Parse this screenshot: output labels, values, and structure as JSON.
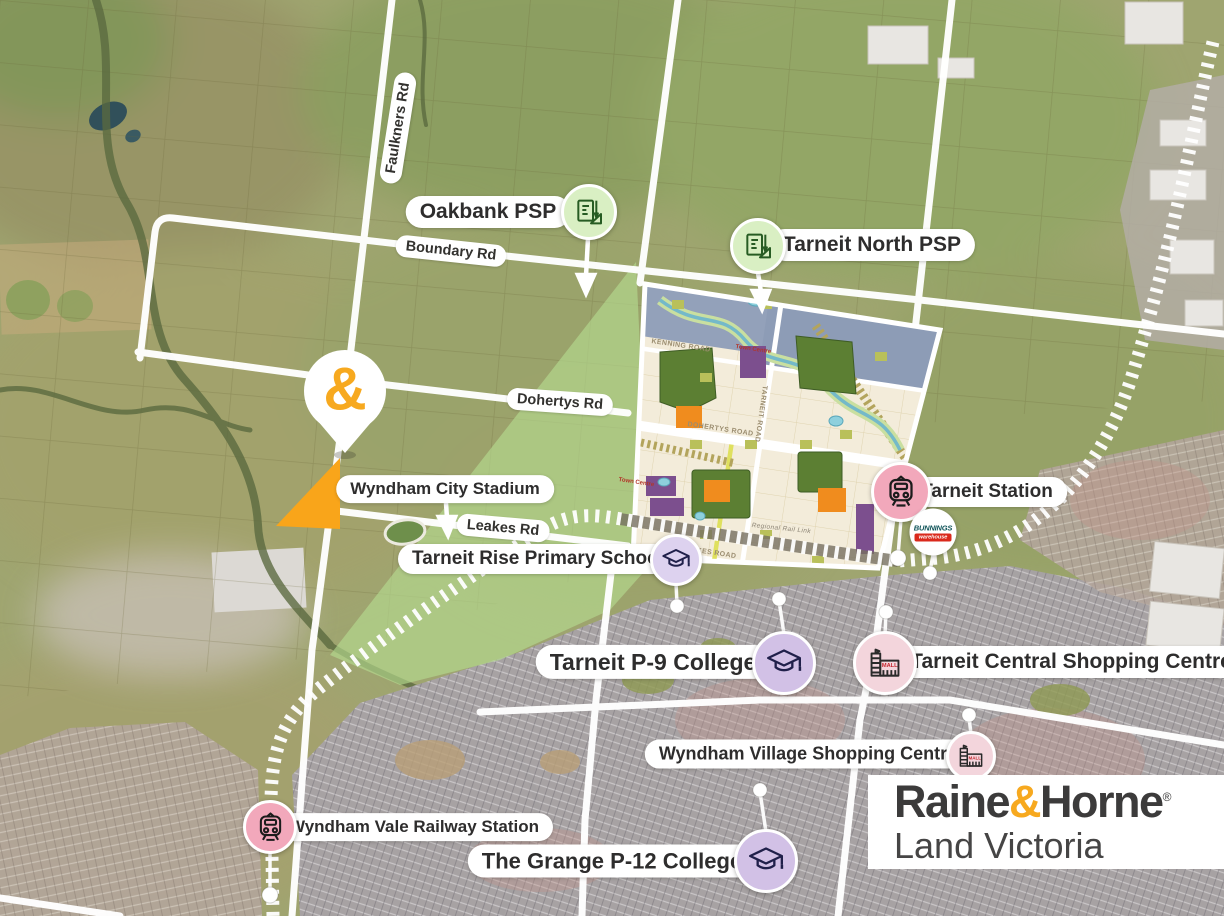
{
  "brand": {
    "pin_symbol": "&",
    "accent_orange": "#F7A91F",
    "site_orange": "#F9A51A",
    "logo_line1_pre": "Raine",
    "logo_amp": "&",
    "logo_line1_post": "Horne",
    "registered": "®",
    "logo_line2": "Land Victoria"
  },
  "roads": {
    "faulkners": "Faulkners Rd",
    "boundary": "Boundary Rd",
    "dohertys": "Dohertys Rd",
    "leakes": "Leakes Rd"
  },
  "markers": {
    "oakbank_psp": {
      "label": "Oakbank PSP",
      "icon": "psp-plan-icon",
      "icon_bg": "#d9efc3"
    },
    "tarneit_north_psp": {
      "label": "Tarneit North PSP",
      "icon": "psp-plan-icon",
      "icon_bg": "#d9efc3"
    },
    "wyndham_city_stadium": {
      "label": "Wyndham City Stadium"
    },
    "tarneit_rise_primary": {
      "label": "Tarneit Rise Primary School",
      "icon": "graduation-cap-icon",
      "icon_bg": "#ddd2ef"
    },
    "tarneit_p9_college": {
      "label": "Tarneit P-9 College",
      "icon": "graduation-cap-icon",
      "icon_bg": "#d2c1e6"
    },
    "tarneit_station": {
      "label": "Tarneit Station",
      "icon": "train-icon",
      "icon_bg": "#f2a8bb"
    },
    "tarneit_central_shopping": {
      "label": "Tarneit Central Shopping Centre",
      "icon": "mall-icon",
      "icon_bg": "#f3d5dc"
    },
    "wyndham_village_shopping": {
      "label": "Wyndham Village Shopping Centre",
      "icon": "mall-icon",
      "icon_bg": "#f3d5dc"
    },
    "wyndham_vale_station": {
      "label": "Wyndham Vale Railway Station",
      "icon": "train-icon",
      "icon_bg": "#f2a8bb"
    },
    "grange_college": {
      "label": "The Grange P-12 College",
      "icon": "graduation-cap-icon",
      "icon_bg": "#d2c1e6"
    }
  },
  "plan": {
    "labels": {
      "kenning": "KENNING ROAD",
      "dohertys": "DOHERTYS ROAD",
      "tarneit": "TARNEIT ROAD",
      "leakes": "LEAKES ROAD",
      "rail_link": "Regional Rail Link",
      "town_centre_north": "Town Centre",
      "town_centre_west": "Town Centre"
    }
  },
  "bunnings": {
    "line1": "BUNNINGS",
    "line2": "warehouse",
    "green": "#0d5257",
    "red": "#da291c"
  }
}
